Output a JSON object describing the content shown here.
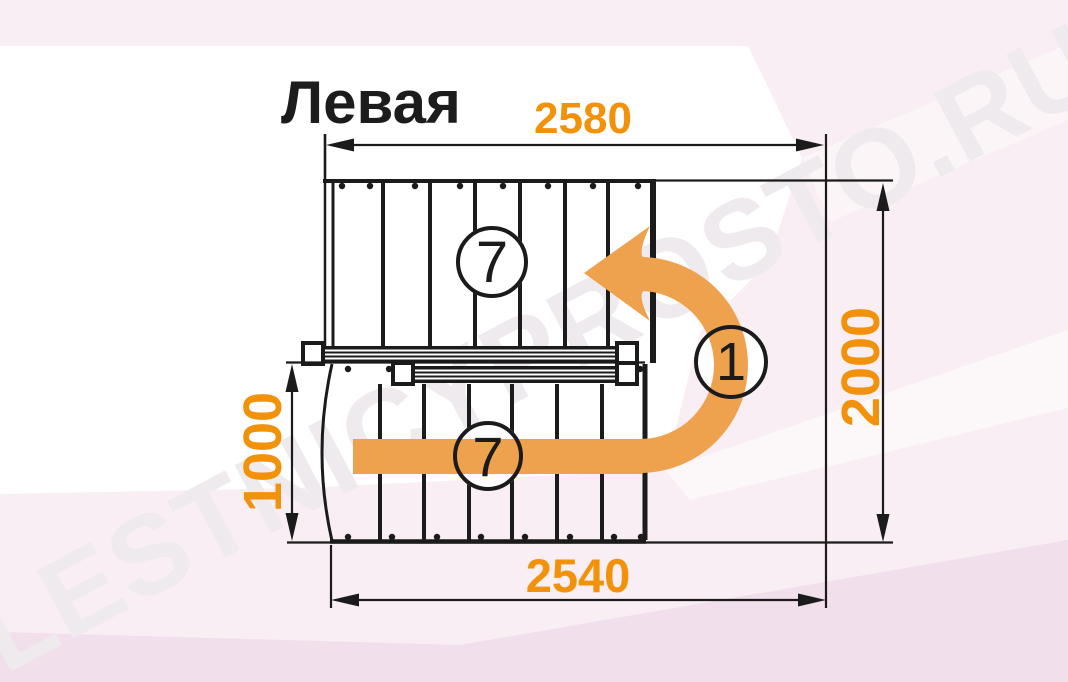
{
  "title": "Левая",
  "watermark": {
    "text": "LESTNICYPROSTO.RU"
  },
  "dimensions": {
    "top": {
      "value": "2580",
      "orientation": "horizontal"
    },
    "bottom": {
      "value": "2540",
      "orientation": "horizontal"
    },
    "right": {
      "value": "2000",
      "orientation": "vertical"
    },
    "left": {
      "value": "1000",
      "orientation": "vertical"
    }
  },
  "badges": {
    "upper_flight_steps": "7",
    "lower_flight_steps": "7",
    "landing": "1"
  },
  "colors": {
    "dimension_text": "#F2920B",
    "turn_arrow": "#EFA24E",
    "line": "#1B1B1B",
    "background": "#F8EEF3",
    "watermark": "#EFEAED"
  }
}
